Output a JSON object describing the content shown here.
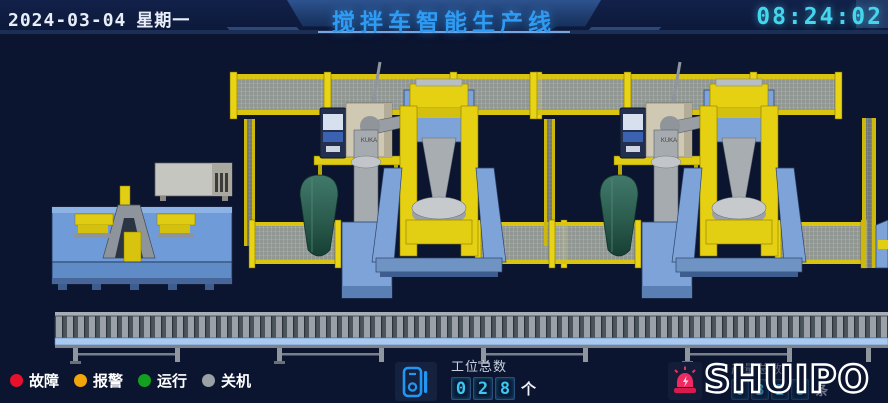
{
  "header": {
    "date": "2024-03-04",
    "weekday": "星期一",
    "title": "搅拌车智能生产线",
    "time": "08:24:02"
  },
  "status_legend": {
    "items": [
      {
        "label": "故障",
        "status": "fault",
        "color": "#e8112d"
      },
      {
        "label": "报警",
        "status": "alarm",
        "color": "#f2a60a"
      },
      {
        "label": "运行",
        "status": "running",
        "color": "#12a01e"
      },
      {
        "label": "关机",
        "status": "off",
        "color": "#9aa0a6"
      }
    ]
  },
  "station_counter": {
    "icon": "tally-device-icon",
    "label": "工位总数",
    "digits": [
      "0",
      "2",
      "8"
    ],
    "unit": "个"
  },
  "production_counter": {
    "label": "产量总数",
    "digits": [
      "0",
      "3",
      "2",
      "8"
    ],
    "unit": "条"
  },
  "brand": {
    "logo_text": "SHUIPO",
    "alarm_icon": "siren-icon"
  },
  "scene": {
    "cabinet_label": "KUKA"
  },
  "colors": {
    "background": "#0b1530",
    "header_banner": "#24477f",
    "title_text": "#2f9bf2",
    "clock_text": "#45d5ee",
    "accent_line": "#7ba6dd",
    "fence_yellow": "#e2cf14",
    "machine_blue": "#6f9bd8",
    "robot_gray": "#a6abb0",
    "drum_teal": "#2f6354",
    "conveyor_rail_blue": "#a9c9ef",
    "digit_cyan": "#3fc6f0",
    "siren_pink": "#ef2a62"
  }
}
